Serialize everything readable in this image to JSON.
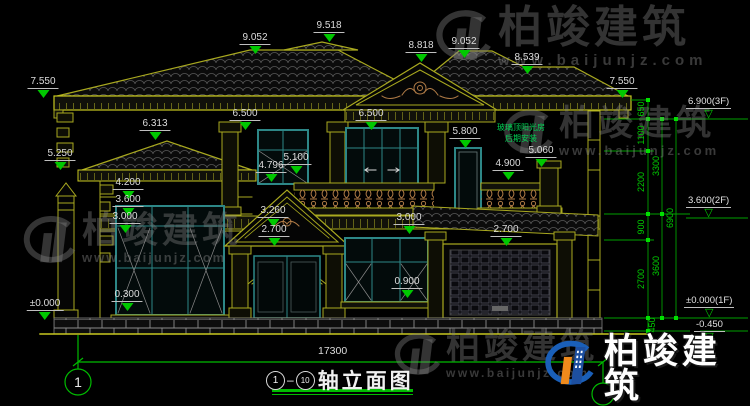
{
  "colors": {
    "background": "#000000",
    "wall_olive": "#a9a91f",
    "window_teal": "#2d8787",
    "dimension_green": "#00c800",
    "ornament_tan": "#b07b46",
    "text_white": "#dcdcdc",
    "logo_blue": "#1a5fb8",
    "logo_orange": "#ef8a1c"
  },
  "watermark": {
    "brand": "柏竣建筑",
    "url": "www.baijunjz.com"
  },
  "labels": {
    "ridge_left": "9.052",
    "ridge_main": "9.518",
    "gable_peak": "8.818",
    "ridge_right": "9.052",
    "ridge_break": "8.539",
    "eave_left": "7.550",
    "eave_right": "7.550",
    "porch_peak": "6.313",
    "window2f_left_head": "6.500",
    "balcony_door_head": "6.500",
    "sunroom_door_head": "5.800",
    "porch_eave": "5.250",
    "window2f_sill": "5.100",
    "window2f_sill2": "4.796",
    "terrace_rail": "4.900",
    "terrace_pier": "5.060",
    "wing_band_top": "4.200",
    "wing_band_mid": "3.600",
    "wing_band_low": "3.000",
    "entry_gable": "3.260",
    "entry_door_head": "2.700",
    "balcony_floor": "3.000",
    "garage_door_head": "2.700",
    "window1f_sill": "0.900",
    "wing_window_sill": "0.300",
    "ground": "±0.000"
  },
  "right_levels": {
    "f3": "6.900(3F)",
    "f2": "3.600(2F)",
    "f1": "±0.000(1F)",
    "base": "-0.450"
  },
  "chain": {
    "c650": "650",
    "c1100": "1100",
    "c2200": "2200",
    "c900": "900",
    "c2700": "2700",
    "c450": "450",
    "c3300": "3300",
    "c3600": "3600",
    "c6900": "6900"
  },
  "note": {
    "line1": "玻璃顶阳光房",
    "line2": "后期安装"
  },
  "footer": {
    "total_width": "17300",
    "axis_left_bubble": "1",
    "axis_from": "1",
    "axis_to": "10",
    "title": "轴立面图"
  }
}
